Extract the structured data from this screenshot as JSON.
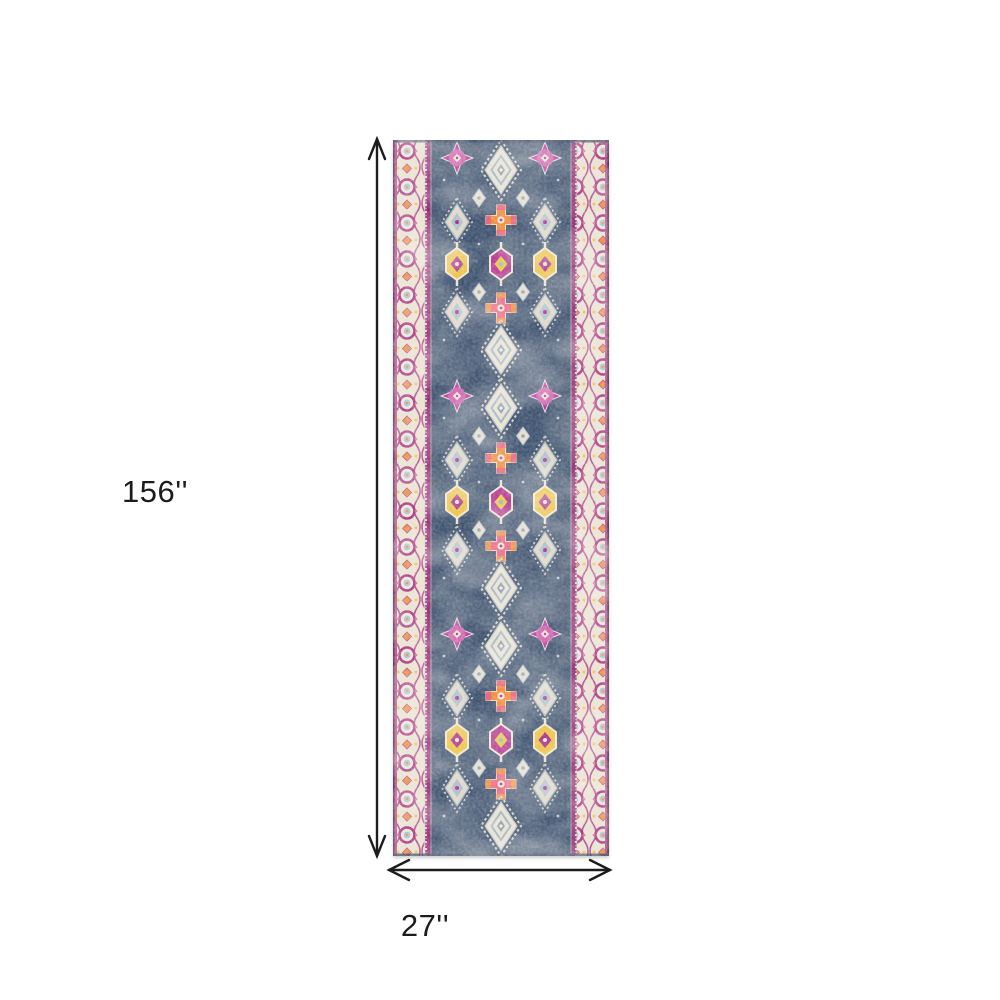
{
  "diagram": {
    "type": "rug-size-diagram",
    "height_label": "156''",
    "width_label": "27''"
  },
  "rug": {
    "description": "navy and magenta distressed oriental runner rug with side borders",
    "palette": {
      "field_navy": "#3f5370",
      "border_cream": "#e9e2d2",
      "magenta": "#b42e8e",
      "pink": "#e8607a",
      "orange": "#ee8a3a",
      "yellow": "#ecc242",
      "light_blue": "#a9bfcf",
      "guard_magenta": "#8f2d72",
      "edge_plum": "#553050"
    }
  },
  "style": {
    "background": "#ffffff",
    "dimension_color": "#1c1c1c"
  }
}
